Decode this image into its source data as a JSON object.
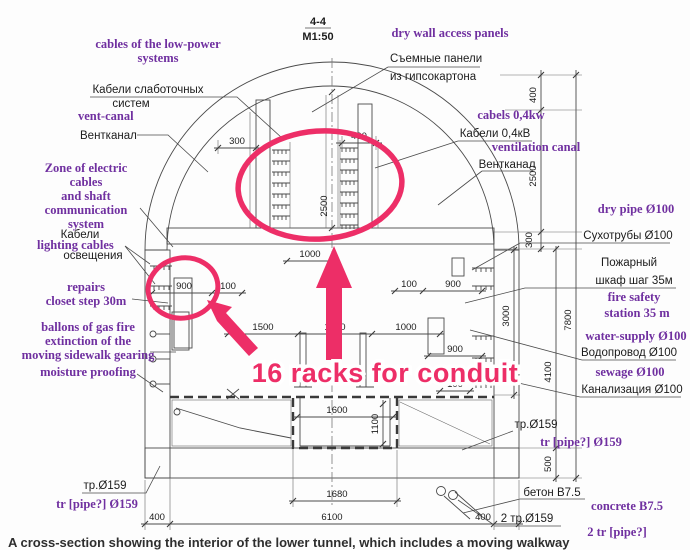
{
  "header": {
    "section_ref": "4-4",
    "scale": "M1:50"
  },
  "highlight": {
    "label": "16 racks for conduit"
  },
  "caption": "A cross-section showing the interior of the lower tunnel, which includes a moving walkway",
  "colors": {
    "annotation_purple": "#7030a0",
    "highlight_pink": "#ed2e67",
    "drawing_line": "#4a4a4a"
  },
  "annotations": {
    "low_power_en": [
      "cables of the low-power",
      "systems"
    ],
    "low_power_ru": [
      "Кабели слаботочных",
      "систем"
    ],
    "vent_left_en": "vent-canal",
    "vent_left_ru": "Вентканал",
    "zone_en": [
      "Zone of electric",
      "cables",
      "and shaft",
      "communication",
      "system"
    ],
    "lighting_ru_top": "Кабели",
    "lighting_en": "lighting cables",
    "lighting_ru_bottom": "освещения",
    "repairs_en": [
      "repairs",
      "closet step 30m"
    ],
    "ballons_en": [
      "ballons of gas fire",
      "extinction of the",
      "moving sidewalk gearing"
    ],
    "moisture_en": "moisture proofing",
    "pipe_left_ru": "тр.Ø159",
    "pipe_left_en": "tr [pipe?] Ø159",
    "drywall_en": "dry wall access panels",
    "drywall_ru": [
      "Съемные панели",
      "из гипсокартона"
    ],
    "cables04_en": "cabels 0,4kw",
    "cables04_ru": "Кабели 0,4кВ",
    "vent_right_en": "ventilation canal",
    "vent_right_ru": "Вентканал",
    "drypipe_en": "dry pipe Ø100",
    "drypipe_ru": "Сухотрубы Ø100",
    "fire_ru": [
      "Пожарный",
      "шкаф  шаг 35м"
    ],
    "fire_en": [
      "fire safety",
      "station 35 m"
    ],
    "water_en": "water-supply Ø100",
    "water_ru": "Водопровод Ø100",
    "sewage_en": "sewage Ø100",
    "sewage_ru": "Канализация Ø100",
    "pipe_right_ru": "тр.Ø159",
    "pipe_right_en": "tr [pipe?] Ø159",
    "concrete_ru": "бетон В7.5",
    "concrete_en": "concrete B7.5",
    "pipe2_ru": "2 тр.Ø159",
    "pipe2_en": "2 tr [pipe?]"
  },
  "dimensions": {
    "d300": "300",
    "d400_top": "400",
    "d2500_mid": "2500",
    "d1000_top": "1000",
    "d900_left": "900",
    "d100_left": "100",
    "d100_right": "100",
    "d900_right": "900",
    "d1500": "1500",
    "d1200": "1200",
    "d1000_mid": "1000",
    "d900_right2": "900",
    "d100_right2": "100",
    "d1600": "1600",
    "d1100": "1100",
    "d1680": "1680",
    "d6100": "6100",
    "d400_bl": "400",
    "d400_br": "400",
    "d400_r": "400",
    "d2500_r": "2500",
    "d300_r": "300",
    "d3000_r": "3000",
    "d4100_r": "4100",
    "d500_r": "500",
    "d7800_r": "7800"
  }
}
